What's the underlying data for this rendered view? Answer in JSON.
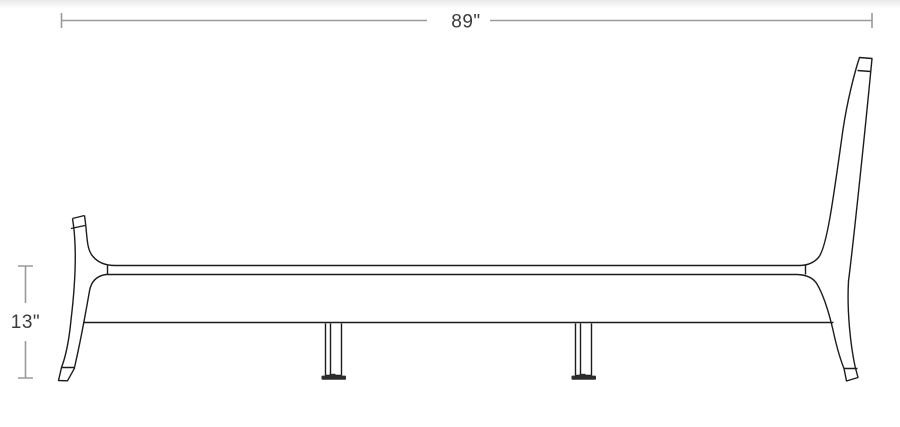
{
  "page": {
    "title": "Bed frame dimension drawing, side elevation view",
    "background": "#ffffff"
  },
  "diagram": {
    "type": "product-dimension-line-drawing",
    "subject": "bed-frame-side-view",
    "dimensions": [
      {
        "id": "overall-length",
        "orientation": "horizontal",
        "label": "89\"",
        "value_inches": 89
      },
      {
        "id": "frame-height",
        "orientation": "vertical",
        "label": "13\"",
        "value_inches": 13
      }
    ],
    "visible_parts": [
      "headboard-post",
      "footboard-post",
      "side-rail",
      "center-leg-1",
      "center-leg-2",
      "leg-floor-glides"
    ]
  },
  "colors": {
    "dimension_line": "#9a9a9a",
    "dimension_text": "#3b3b3b",
    "drawing_stroke": "#1c1c1c",
    "glide_fill": "#2d2d2d",
    "background": "#ffffff"
  }
}
